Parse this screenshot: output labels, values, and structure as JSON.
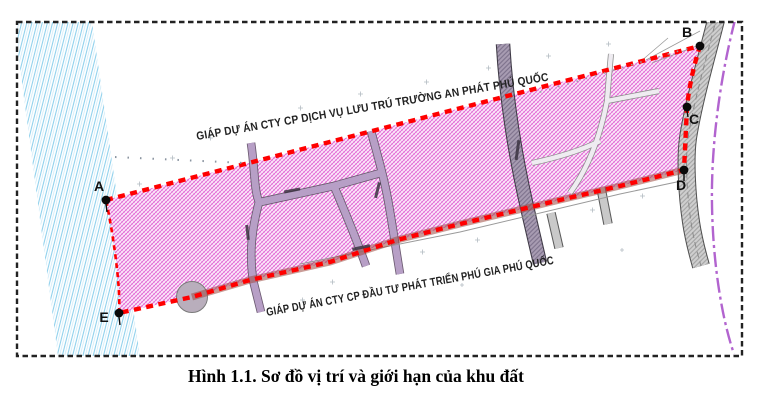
{
  "caption": "Hình 1.1. Sơ đồ vị trí và giới hạn của khu đất",
  "map": {
    "north_boundary_label": "GIÁP DỰ ÁN CTY CP DỊCH VỤ LƯU TRÚ TRƯỜNG AN PHÁT PHÚ QUỐC",
    "south_boundary_label": "GIÁP DỰ ÁN CTY CP ĐẦU TƯ PHÁT TRIỂN PHÚ GIA PHÚ QUỐC",
    "vertex_labels": [
      "A",
      "B",
      "C",
      "D",
      "E"
    ],
    "colors": {
      "boundary_red": "#ff0000",
      "boundary_underlay": "#9c4a42",
      "site_pink": "#e05fd3",
      "water_blue": "#8fd0ec",
      "admin_purple": "#b264cf",
      "road_gray": "#c9c9c9",
      "border_black": "#222222"
    }
  }
}
